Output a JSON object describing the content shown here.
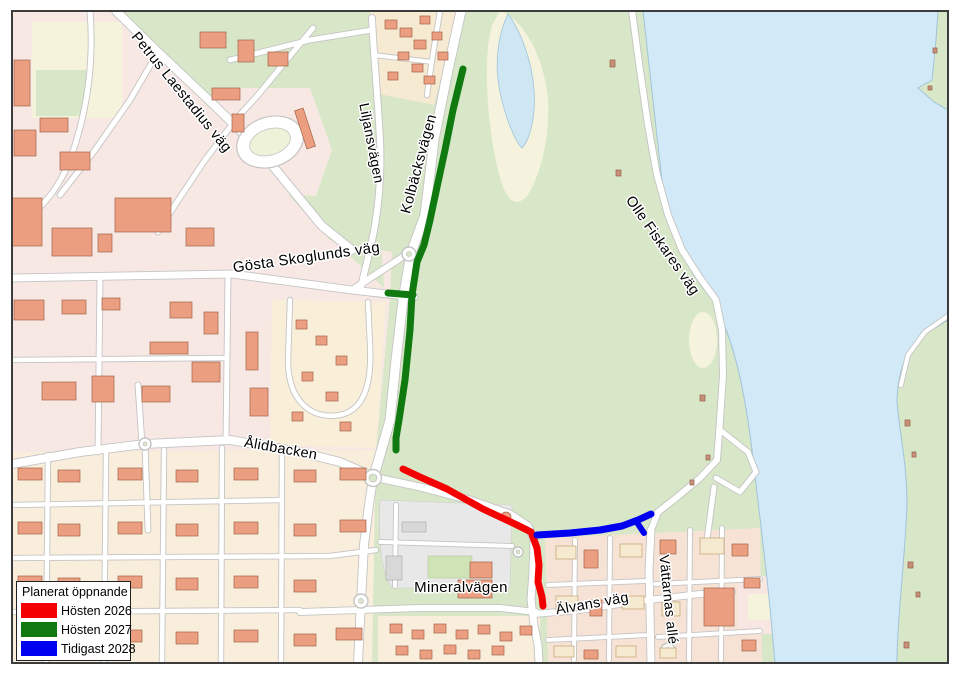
{
  "legend": {
    "title": "Planerat öppnande",
    "items": [
      {
        "id": "hosten-2026",
        "label": "Hösten 2026",
        "color": "#f40000"
      },
      {
        "id": "hosten-2027",
        "label": "Hösten 2027",
        "color": "#107a10"
      },
      {
        "id": "tidigast-2028",
        "label": "Tidigast 2028",
        "color": "#0000f0"
      }
    ]
  },
  "map": {
    "street_labels": [
      {
        "name": "petrus-laestadius-vag",
        "text": "Petrus Laestadius väg",
        "x": 178,
        "y": 95,
        "rotate": 51,
        "size": 14.5
      },
      {
        "name": "liljansvagen",
        "text": "Liljansvägen",
        "x": 367,
        "y": 144,
        "rotate": 79,
        "size": 14
      },
      {
        "name": "kolbacksvagen",
        "text": "Kolbäcksvägen",
        "x": 423,
        "y": 165,
        "rotate": -75,
        "size": 14.5
      },
      {
        "name": "gosta-skoglunds-vag",
        "text": "Gösta Skoglunds väg",
        "x": 307,
        "y": 262,
        "rotate": -8,
        "size": 15
      },
      {
        "name": "olle-fiskares-vag",
        "text": "Olle Fiskares väg",
        "x": 659,
        "y": 248,
        "rotate": 55,
        "size": 14.5
      },
      {
        "name": "alidbacken",
        "text": "Ålidbacken",
        "x": 280,
        "y": 453,
        "rotate": 10,
        "size": 14.5
      },
      {
        "name": "mineralvagen",
        "text": "Mineralvägen",
        "x": 461,
        "y": 592,
        "rotate": 0,
        "size": 15
      },
      {
        "name": "alvans-vag",
        "text": "Älvans väg",
        "x": 593,
        "y": 608,
        "rotate": -10,
        "size": 14.5
      },
      {
        "name": "vattarnas-alle",
        "text": "Vättarnas allé",
        "x": 664,
        "y": 600,
        "rotate": 84,
        "size": 14
      }
    ],
    "routes": [
      {
        "name": "route-hosten-2026",
        "opens": "Hösten 2026",
        "width": 7,
        "points": "403,469 420,477 447,489 483,509 515,524 531,532 537,548 539,565 538,582 542,597 543,606"
      },
      {
        "name": "route-hosten-2027-kolbacksvagen",
        "opens": "Hösten 2027",
        "width": 7,
        "points": "463,69 453,110 445,150 437,187 430,220 424,245 417,262 412,295 410,330 405,380 399,420 396,438 396,450"
      },
      {
        "name": "route-hosten-2027-gosta-link",
        "opens": "Hösten 2027",
        "width": 7,
        "points": "388,293 413,295"
      },
      {
        "name": "route-tidigast-2028",
        "opens": "Tidigast 2028",
        "width": 7,
        "points": "537,535 570,533 600,530 622,526 638,520 651,514"
      },
      {
        "name": "route-tidigast-2028-branch",
        "opens": "Tidigast 2028",
        "width": 6,
        "points": "636,521 644,533"
      }
    ]
  }
}
